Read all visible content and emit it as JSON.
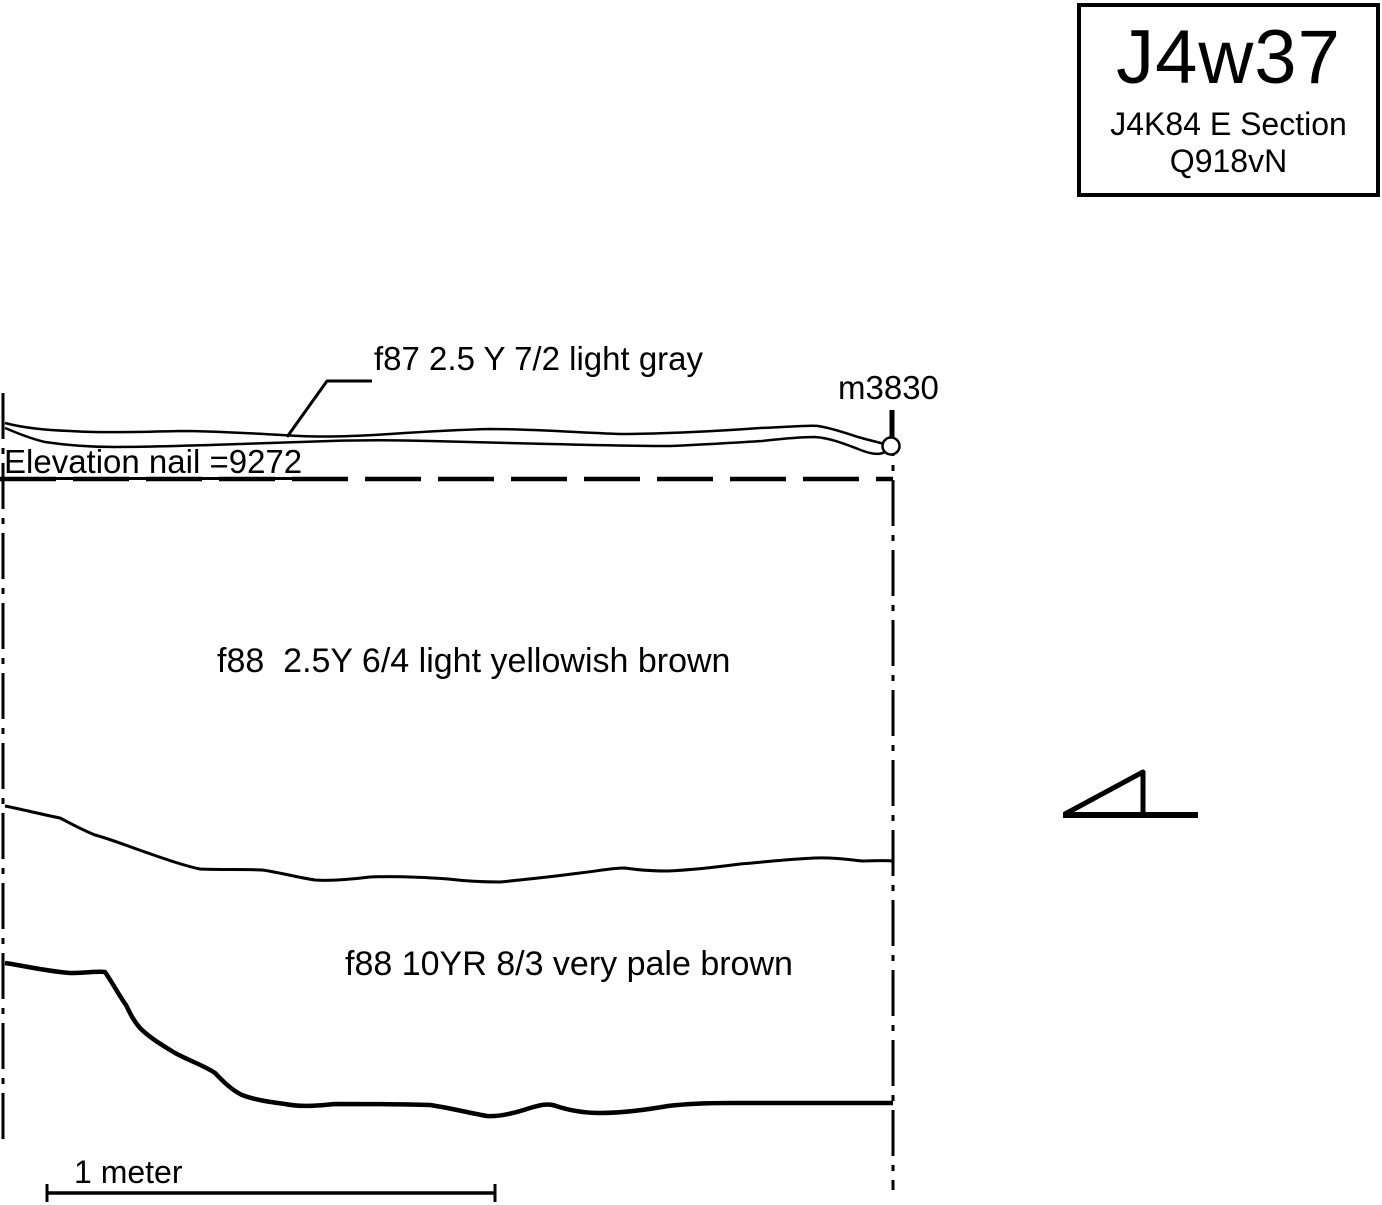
{
  "title_box": {
    "code": "J4w37",
    "section": "J4K84 E Section",
    "locus": "Q918vN"
  },
  "labels": {
    "f87_layer": "f87 2.5 Y 7/2 light gray",
    "nail_point": "m3830",
    "elevation_note": "Elevation nail =9272",
    "f88_upper_layer": "f88  2.5Y 6/4 light yellowish brown",
    "f88_lower_layer": "f88 10YR 8/3 very pale brown",
    "scale_bar": "1 meter"
  },
  "values": {
    "elevation_value": "9272",
    "nail_id": "m3830",
    "scale_length": "1 meter"
  },
  "icons": {
    "nail_circle": "datum-nail-marker",
    "slope_triangle": "section-facing-triangle"
  },
  "colors": {
    "ink": "#000000",
    "background": "#ffffff"
  }
}
